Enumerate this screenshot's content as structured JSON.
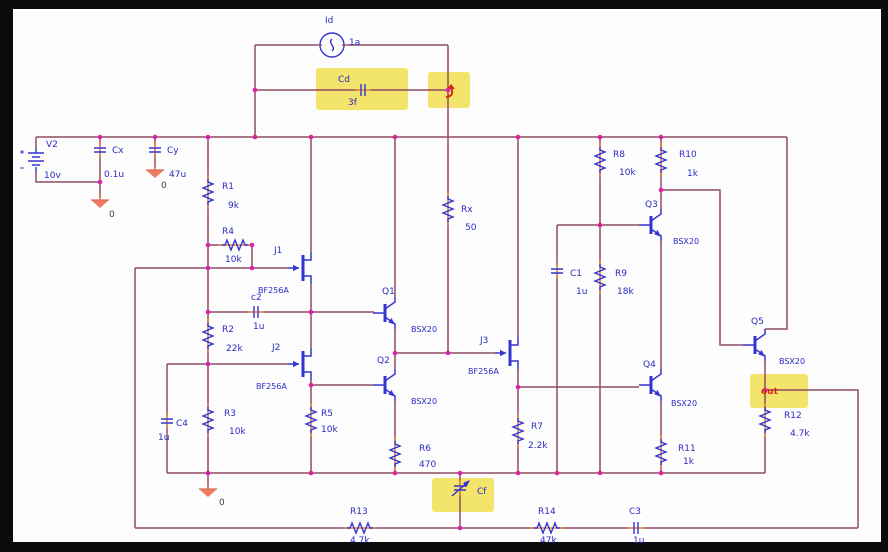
{
  "schematic": {
    "sources": {
      "V2": {
        "name": "V2",
        "value": "10v"
      },
      "Id": {
        "name": "Id",
        "value": "1a"
      }
    },
    "resistors": {
      "R1": {
        "name": "R1",
        "value": "9k"
      },
      "R2": {
        "name": "R2",
        "value": "22k"
      },
      "R3": {
        "name": "R3",
        "value": "10k"
      },
      "R4": {
        "name": "R4",
        "value": "10k"
      },
      "R5": {
        "name": "R5",
        "value": "10k"
      },
      "R6": {
        "name": "R6",
        "value": "470"
      },
      "R7": {
        "name": "R7",
        "value": "2.2k"
      },
      "R8": {
        "name": "R8",
        "value": "10k"
      },
      "R9": {
        "name": "R9",
        "value": "18k"
      },
      "R10": {
        "name": "R10",
        "value": "1k"
      },
      "R11": {
        "name": "R11",
        "value": "1k"
      },
      "R12": {
        "name": "R12",
        "value": "4.7k"
      },
      "R13": {
        "name": "R13",
        "value": "4.7k"
      },
      "R14": {
        "name": "R14",
        "value": "47k"
      },
      "Rx": {
        "name": "Rx",
        "value": "50"
      }
    },
    "capacitors": {
      "Cx": {
        "name": "Cx",
        "value": "0.1u"
      },
      "Cy": {
        "name": "Cy",
        "value": "47u"
      },
      "Cd": {
        "name": "Cd",
        "value": "3f"
      },
      "c2": {
        "name": "c2",
        "value": "1u"
      },
      "C4": {
        "name": "C4",
        "value": "1u"
      },
      "C1": {
        "name": "C1",
        "value": "1u"
      },
      "C3": {
        "name": "C3",
        "value": "1u"
      },
      "Cf": {
        "name": "Cf",
        "value": ""
      }
    },
    "jfets": {
      "J1": {
        "name": "J1",
        "model": "BF256A"
      },
      "J2": {
        "name": "J2",
        "model": "BF256A"
      },
      "J3": {
        "name": "J3",
        "model": "BF256A"
      }
    },
    "bjts": {
      "Q1": {
        "name": "Q1",
        "model": "BSX20"
      },
      "Q2": {
        "name": "Q2",
        "model": "BSX20"
      },
      "Q3": {
        "name": "Q3",
        "model": "BSX20"
      },
      "Q4": {
        "name": "Q4",
        "model": "BSX20"
      },
      "Q5": {
        "name": "Q5",
        "model": "BSX20"
      }
    },
    "ground_label": "0",
    "net_labels": {
      "out": "out"
    },
    "colors": {
      "wire": "#8e4d63",
      "component": "#3434cf",
      "junction": "#dd22aa",
      "highlight": "#f2e25f",
      "ground": "#ef7b63",
      "marker": "#d92613",
      "frame": "#0b0b0b"
    }
  }
}
